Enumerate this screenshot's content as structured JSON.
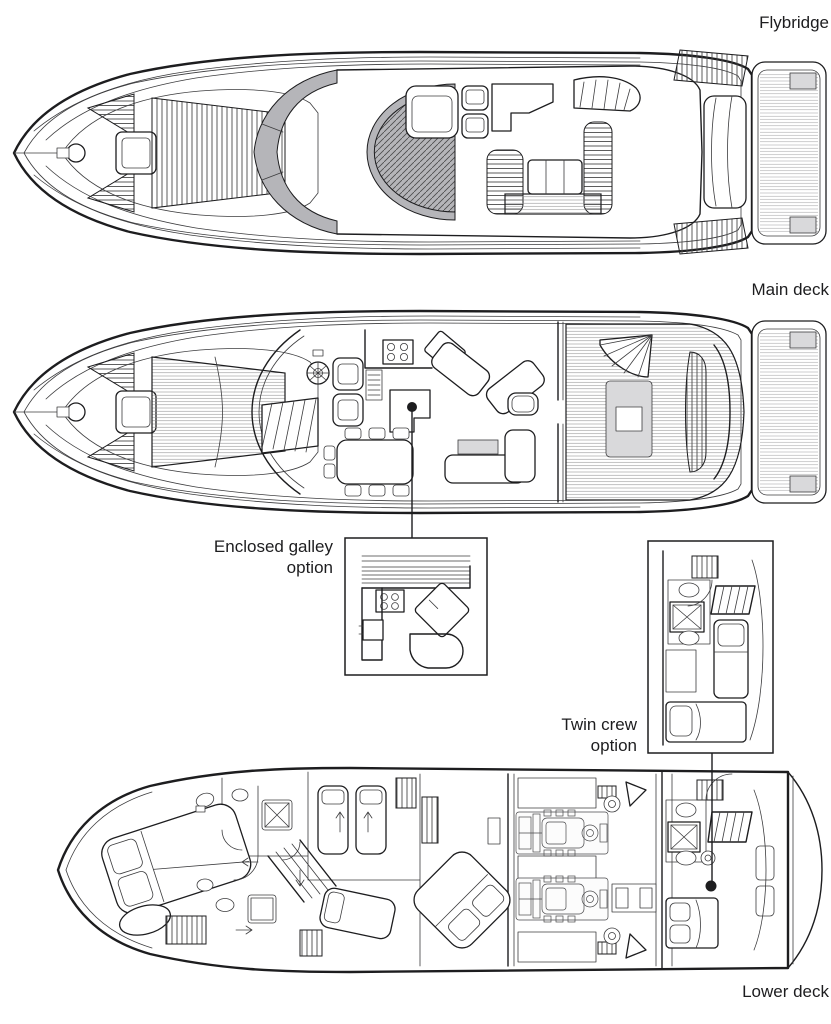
{
  "labels": {
    "deck_flybridge": "Flybridge",
    "deck_main": "Main deck",
    "deck_lower": "Lower deck",
    "option_galley_line1": "Enclosed galley",
    "option_galley_line2": "option",
    "option_crew_line1": "Twin crew",
    "option_crew_line2": "option"
  },
  "colors": {
    "line": "#1d1d1f",
    "window_gray": "#b5b5b9",
    "panel_gray": "#d9d9db",
    "hatch": "#4a4a4a",
    "background": "#ffffff"
  }
}
